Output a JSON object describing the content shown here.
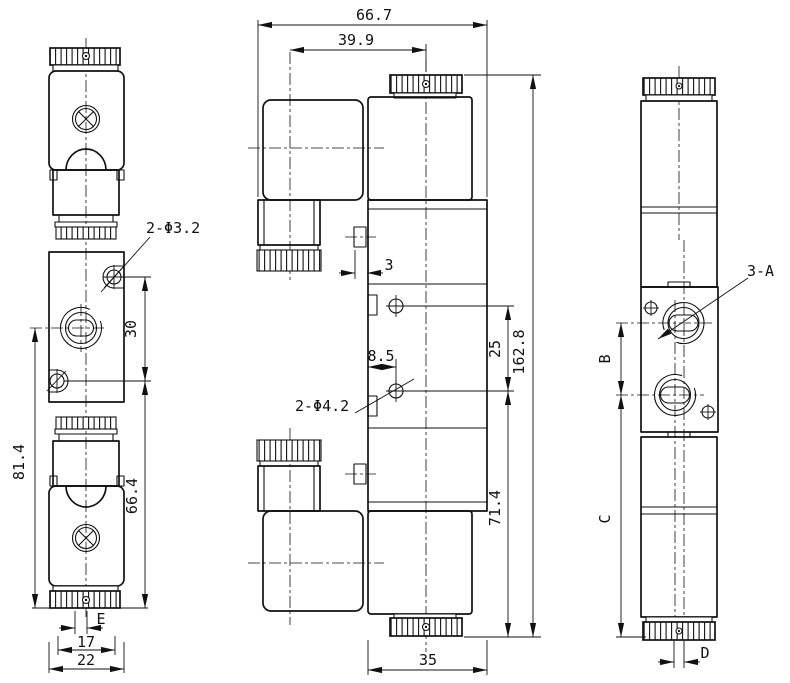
{
  "colors": {
    "background": "#ffffff",
    "line": "#111111"
  },
  "left_view": {
    "hole_callout": "2-Φ3.2",
    "dim_hole_spacing": "30",
    "dim_overall_height": "81.4",
    "dim_body_height": "66.4",
    "dim_exhaust_width": "E",
    "dim_cap_width": "17",
    "dim_overall_width": "22"
  },
  "front_view": {
    "dim_overall_width": "66.7",
    "dim_connector_offset": "39.9",
    "dim_tab_depth": "3",
    "dim_hole_offset": "8.5",
    "dim_hole_spacing": "25",
    "dim_overall_height": "162.8",
    "dim_lower_height": "71.4",
    "dim_body_width": "35",
    "hole_callout": "2-Φ4.2"
  },
  "right_view": {
    "port_callout": "3-A",
    "dim_port_spacing": "B",
    "dim_lower_height": "C",
    "dim_port_offset": "D"
  }
}
